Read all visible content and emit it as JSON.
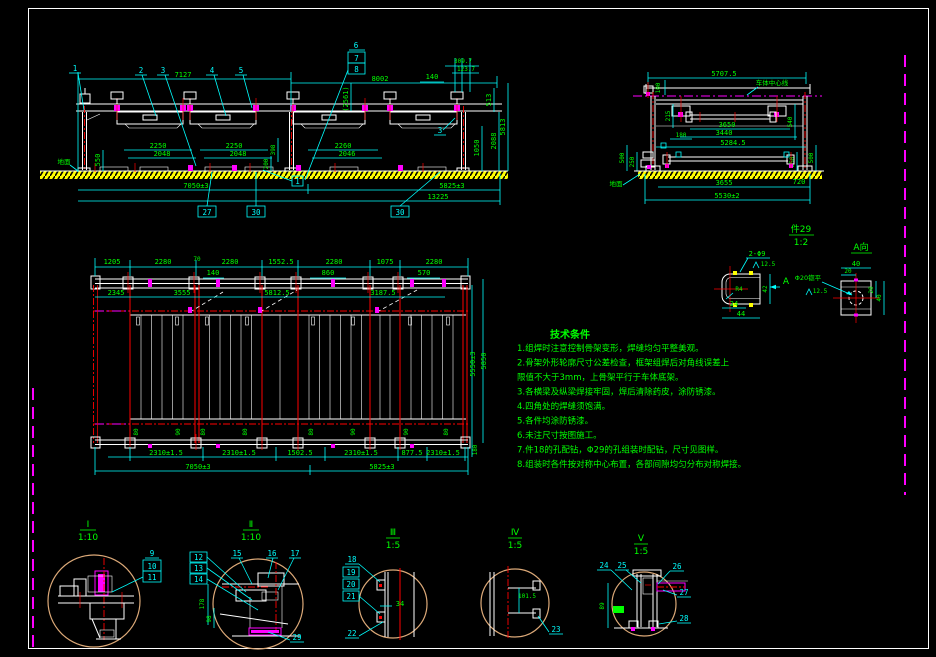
{
  "sheet": {
    "bg": "#000000",
    "frame": "#ffffff",
    "cyan": "#00ffff",
    "green": "#00ff00",
    "red": "#ff0000",
    "magenta": "#ff00ff",
    "ground_yellow": "#d8d800",
    "detail_circle": "#dca978"
  },
  "view1": {
    "balloons": {
      "b1": "1",
      "b2": "2",
      "b3": "3",
      "b4": "4",
      "b5": "5",
      "b6": "6",
      "b7": "7",
      "b8": "8",
      "b3b": "3",
      "b1box": "1"
    },
    "boxed": {
      "b27": "27",
      "b30a": "30",
      "b30b": "30"
    },
    "dims": {
      "d7127": "7127",
      "d2561": "(2561)",
      "d8002": "8002",
      "d140": "140",
      "d3097": "309.7",
      "d1237": "123.7",
      "d513": "513",
      "d2088": "2088",
      "d5813": "5813",
      "d1050": "1050",
      "d550": "550",
      "d398": "398",
      "d200": "200",
      "p1a": "2250",
      "p1b": "2048",
      "p2a": "2250",
      "p2b": "2048",
      "p3a": "2260",
      "p3b": "2046",
      "d7050": "7050±3",
      "d5825": "5825±3",
      "d13225": "13225"
    },
    "ground_label": "地面"
  },
  "view2": {
    "dims": {
      "d57075": "5707.5",
      "d100": "100",
      "d215": "215",
      "d180": "180",
      "d3650": "3650",
      "d3440": "3440",
      "d52845": "5284.5",
      "d540": "540",
      "d500l": "500",
      "d250l": "250",
      "d250r": "250",
      "d500r": "500",
      "d3655": "3655",
      "d720": "720",
      "d5530": "5530±2"
    },
    "centerline_label": "车体中心线",
    "ground_label": "地面"
  },
  "view3": {
    "top_dims": [
      "1205",
      "2280",
      "70",
      "2280",
      "1552.5",
      "2280",
      "1075",
      "2280"
    ],
    "leader_dims": {
      "d140": "140",
      "d860": "860",
      "d570": "570"
    },
    "inner_dims": [
      "2345",
      "3555",
      "5812.5",
      "3187.5"
    ],
    "right_dims": {
      "d5550": "5550±3",
      "d5850": "5850",
      "d180": "180"
    },
    "bottom_dims": [
      "2310±1.5",
      "2310±1.5",
      "1502.5",
      "2310±1.5",
      "877.5",
      "2310±1.5"
    ],
    "span_dims": {
      "d7050": "7050±3",
      "d5825": "5825±3"
    },
    "gap_labels": [
      "80",
      "90",
      "80",
      "80",
      "80",
      "90",
      "90",
      "80"
    ]
  },
  "notes": {
    "title": "技术条件",
    "items": [
      "1.组焊时注意控制骨架变形，焊缝均匀平整美观。",
      "2.骨架外形轮廓尺寸公差检查，框架组焊后对角线误差上",
      "  限值不大于3mm，上骨架平行于车体底架。",
      "3.各横梁及纵梁焊接牢固，焊后清除药皮，涂防锈漆。",
      "4.四角处的焊缝须饱满。",
      "5.各件均涂防锈漆。",
      "6.未注尺寸按图施工。",
      "7.件18的孔配钻，Φ29的孔组装时配钻，尺寸见图样。",
      "8.组装时各件按对称中心布置，各部间隙均匀分布对称焊接。"
    ]
  },
  "detail29": {
    "title": "件29",
    "scale": "1:2",
    "hole_note": "2-Φ9",
    "rough1": "12.5",
    "radius": "R4",
    "d24": "24",
    "d44": "44",
    "d42": "42",
    "arrow_label": "A",
    "view_label": "A向",
    "counterbore": "Φ20锪平",
    "rough2": "12.5",
    "d40t": "40",
    "d20t": "20",
    "d20r": "20",
    "d40r": "40"
  },
  "details": {
    "d1": {
      "title": "Ⅰ",
      "scale": "1:10",
      "b9": "9",
      "b10": "10",
      "b11": "11"
    },
    "d2": {
      "title": "Ⅱ",
      "scale": "1:10",
      "b12": "12",
      "b13": "13",
      "b14": "14",
      "b15": "15",
      "b16": "16",
      "b17": "17",
      "b29": "29",
      "d178": "178",
      "d98": "98"
    },
    "d3": {
      "title": "Ⅲ",
      "scale": "1:5",
      "b18": "18",
      "b19": "19",
      "b20": "20",
      "b21": "21",
      "b22": "22",
      "d34": "34"
    },
    "d4": {
      "title": "Ⅳ",
      "scale": "1:5",
      "b23": "23",
      "d1015": "101.5"
    },
    "d5": {
      "title": "Ⅴ",
      "scale": "1:5",
      "b24": "24",
      "b25": "25",
      "b26": "26",
      "b27": "27",
      "b28": "28",
      "d89": "89"
    }
  }
}
